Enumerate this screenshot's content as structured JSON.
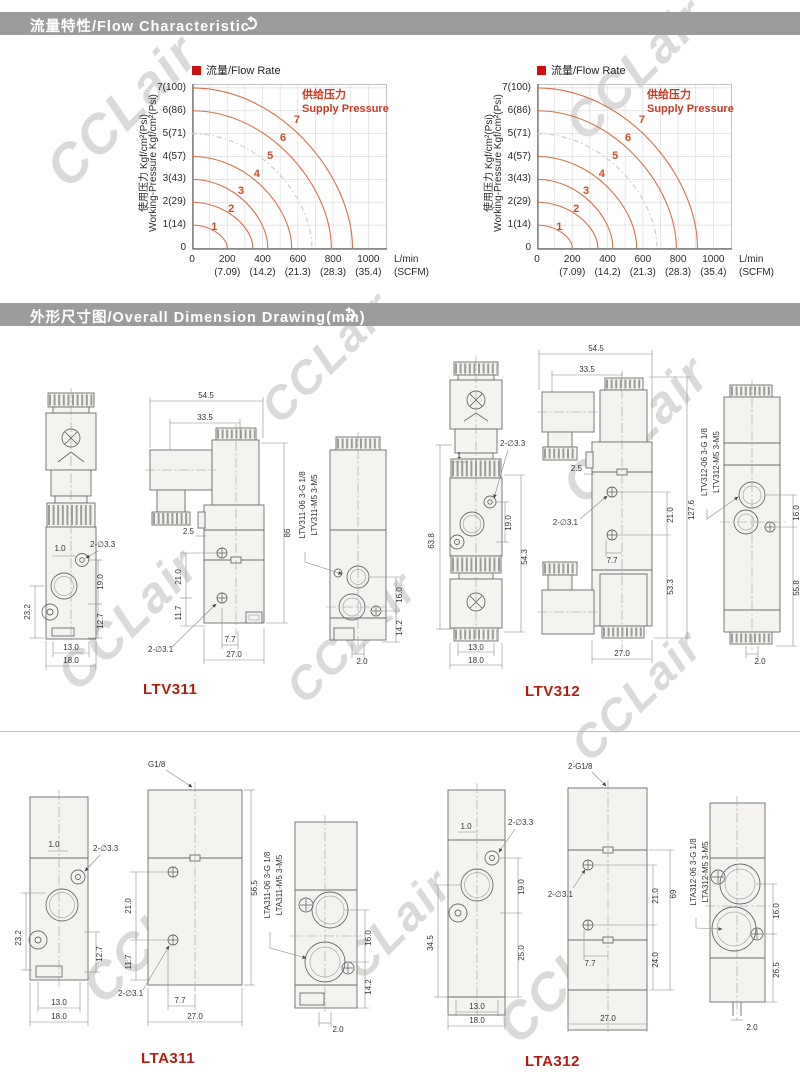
{
  "page": {
    "section1_title": "流量特性/Flow Characteristic",
    "section2_title": "外形尺寸图/Overall Dimension Drawing(mm)",
    "header_bg": "#9c9c9c",
    "accent_red": "#b01e12"
  },
  "watermark": "CCLair",
  "chart_data": [
    {
      "type": "line",
      "legend_label": "流量/Flow Rate",
      "legend_color": "#cc1010",
      "annotation_lines": [
        "供给压力",
        "Supply Pressure"
      ],
      "annotation_color": "#c43c28",
      "ylabel_lines": [
        "使用压力 Kgf/cm²(Psi)",
        "Working-Pressure Kgf/cm²(Psi)"
      ],
      "x_unit": "L/min",
      "x_unit2": "(SCFM)",
      "y_ticks": [
        "7(100)",
        "6(86)",
        "5(71)",
        "4(57)",
        "3(43)",
        "2(29)",
        "1(14)",
        "0"
      ],
      "x_ticks": [
        {
          "v": 0,
          "label": "0"
        },
        {
          "v": 200,
          "label": "200",
          "scfm": "(7.09)"
        },
        {
          "v": 400,
          "label": "400",
          "scfm": "(14.2)"
        },
        {
          "v": 600,
          "label": "600",
          "scfm": "(21.3)"
        },
        {
          "v": 800,
          "label": "800",
          "scfm": "(28.3)"
        },
        {
          "v": 1000,
          "label": "1000",
          "scfm": "(35.4)"
        }
      ],
      "xlim": [
        0,
        1100
      ],
      "ylim": [
        0,
        7.17
      ],
      "grid": true,
      "curve_color": "#d4714b",
      "series": [
        {
          "label": "1",
          "supply_pressure": 1,
          "max_flow_lmin": 200,
          "style": "solid"
        },
        {
          "label": "2",
          "supply_pressure": 2,
          "max_flow_lmin": 345,
          "style": "solid"
        },
        {
          "label": "3",
          "supply_pressure": 3,
          "max_flow_lmin": 430,
          "style": "solid"
        },
        {
          "label": "4",
          "supply_pressure": 4,
          "max_flow_lmin": 565,
          "style": "solid"
        },
        {
          "label": "5",
          "supply_pressure": 5,
          "max_flow_lmin": 680,
          "style": "gray-dashed"
        },
        {
          "label": "6",
          "supply_pressure": 6,
          "max_flow_lmin": 790,
          "style": "solid"
        },
        {
          "label": "7",
          "supply_pressure": 7,
          "max_flow_lmin": 910,
          "style": "solid"
        }
      ]
    },
    {
      "type": "line",
      "legend_label": "流量/Flow Rate",
      "legend_color": "#cc1010",
      "annotation_lines": [
        "供给压力",
        "Supply Pressure"
      ],
      "annotation_color": "#c43c28",
      "ylabel_lines": [
        "使用压力 Kgf/cm²(Psi)",
        "Working-Pressure Kgf/cm²(Psi)"
      ],
      "x_unit": "L/min",
      "x_unit2": "(SCFM)",
      "y_ticks": [
        "7(100)",
        "6(86)",
        "5(71)",
        "4(57)",
        "3(43)",
        "2(29)",
        "1(14)",
        "0"
      ],
      "x_ticks": [
        {
          "v": 0,
          "label": "0"
        },
        {
          "v": 200,
          "label": "200",
          "scfm": "(7.09)"
        },
        {
          "v": 400,
          "label": "400",
          "scfm": "(14.2)"
        },
        {
          "v": 600,
          "label": "600",
          "scfm": "(21.3)"
        },
        {
          "v": 800,
          "label": "800",
          "scfm": "(28.3)"
        },
        {
          "v": 1000,
          "label": "1000",
          "scfm": "(35.4)"
        }
      ],
      "xlim": [
        0,
        1100
      ],
      "ylim": [
        0,
        7.17
      ],
      "grid": true,
      "curve_color": "#d4714b",
      "series": [
        {
          "label": "1",
          "supply_pressure": 1,
          "max_flow_lmin": 200,
          "style": "solid"
        },
        {
          "label": "2",
          "supply_pressure": 2,
          "max_flow_lmin": 345,
          "style": "solid"
        },
        {
          "label": "3",
          "supply_pressure": 3,
          "max_flow_lmin": 430,
          "style": "solid"
        },
        {
          "label": "4",
          "supply_pressure": 4,
          "max_flow_lmin": 565,
          "style": "solid"
        },
        {
          "label": "5",
          "supply_pressure": 5,
          "max_flow_lmin": 680,
          "style": "gray-dashed"
        },
        {
          "label": "6",
          "supply_pressure": 6,
          "max_flow_lmin": 790,
          "style": "solid"
        },
        {
          "label": "7",
          "supply_pressure": 7,
          "max_flow_lmin": 910,
          "style": "solid"
        }
      ]
    }
  ],
  "drawings": {
    "ltv311": {
      "model": "LTV311",
      "front": [
        "1.0",
        "2-∅3.3",
        "19.0",
        "12.7",
        "23.2",
        "13.0",
        "18.0"
      ],
      "side": [
        "54.5",
        "33.5",
        "2.5",
        "21.0",
        "11.7",
        "2-∅3.1",
        "7.7",
        "27.0",
        "86"
      ],
      "right": [
        "LTV311-06  3-G  1/8",
        "LTV311-M5  3-M5",
        "16.0",
        "14.2",
        "2.0"
      ]
    },
    "ltv312": {
      "model": "LTV312",
      "front": [
        "2-∅3.3",
        "1",
        "19.0",
        "54.3",
        "63.8",
        "13.0",
        "18.0"
      ],
      "side": [
        "54.5",
        "33.5",
        "2.5",
        "2-∅3.1",
        "21.0",
        "127.6",
        "7.7",
        "53.3",
        "27.0"
      ],
      "right": [
        "LTV312-06  3-G  1/8",
        "LTV312-M5  3-M5",
        "16.0",
        "55.8",
        "2.0"
      ]
    },
    "lta311": {
      "model": "LTA311",
      "front": [
        "1.0",
        "2-∅3.3",
        "23.2",
        "12.7",
        "13.0",
        "18.0"
      ],
      "side": [
        "G1/8",
        "21.0",
        "11.7",
        "2-∅3.1",
        "7.7",
        "27.0",
        "56.5"
      ],
      "right": [
        "LTA311-06  3-G  1/8",
        "LTA311-M5  3-M5",
        "16.0",
        "14.2",
        "2.0"
      ]
    },
    "lta312": {
      "model": "LTA312",
      "front": [
        "1.0",
        "2-∅3.3",
        "19.0",
        "25.0",
        "34.5",
        "13.0",
        "18.0"
      ],
      "side": [
        "2-G1/8",
        "2-∅3.1",
        "7.7",
        "21.0",
        "69",
        "24.0",
        "27.0"
      ],
      "right": [
        "LTA312-06  3-G  1/8",
        "LTA312-M5  3-M5",
        "16.0",
        "26.5",
        "2.0"
      ]
    }
  }
}
